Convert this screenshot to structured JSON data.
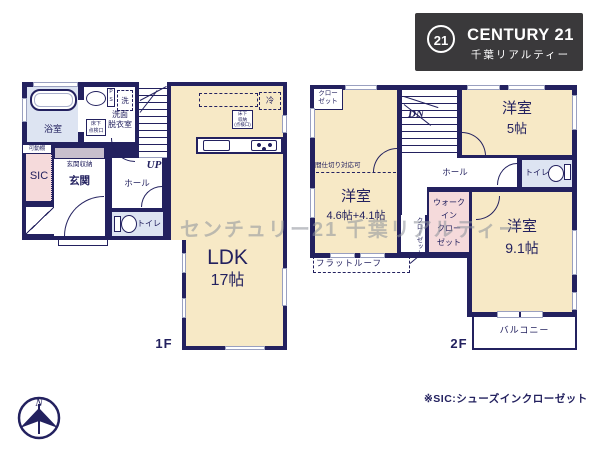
{
  "logo": {
    "number": "21",
    "brand": "CENTURY 21",
    "company": "千葉リアルティー"
  },
  "watermark": "センチュリー21 千葉リアルティー",
  "footnote": "※SIC:シューズインクローゼット",
  "compass_label": "N",
  "colors": {
    "wall": "#23215f",
    "room_cream": "#f7e9c6",
    "room_wet": "#dde4f2",
    "room_pink": "#f5dadb",
    "logo_bg": "#3a393b"
  },
  "floor1": {
    "label": "1F",
    "bath": "浴室",
    "washroom_lines": [
      "洗面",
      "脱衣室"
    ],
    "washer": "洗",
    "ps_lines": [
      "P",
      "S"
    ],
    "inspection_lines": [
      "床下",
      "点検口"
    ],
    "movable_shelf": "可動棚",
    "sic": "SIC",
    "entrance_storage": "玄関収納",
    "entrance": "玄関",
    "hall": "ホール",
    "up": "UP",
    "toilet": "トイレ",
    "ldk_name": "LDK",
    "ldk_size": "17帖",
    "fridge": "冷",
    "underfloor_storage_lines": [
      "床下",
      "収納",
      "(点検口)"
    ]
  },
  "floor2": {
    "label": "2F",
    "closet_lines": [
      "クロー",
      "ゼット"
    ],
    "partition_note": "間仕切り対応可",
    "dn": "DN",
    "room5_name": "洋室",
    "room5_size": "5帖",
    "toilet": "トイレ",
    "hall": "ホール",
    "room46_name": "洋室",
    "room46_size": "4.6帖+4.1帖",
    "closet_vertical": "クローゼット",
    "wic_lines": [
      "ウォーク",
      "イン",
      "クロー",
      "ゼット"
    ],
    "room91_name": "洋室",
    "room91_size": "9.1帖",
    "balcony": "バルコニー",
    "flat_roof": "フラットルーフ"
  }
}
